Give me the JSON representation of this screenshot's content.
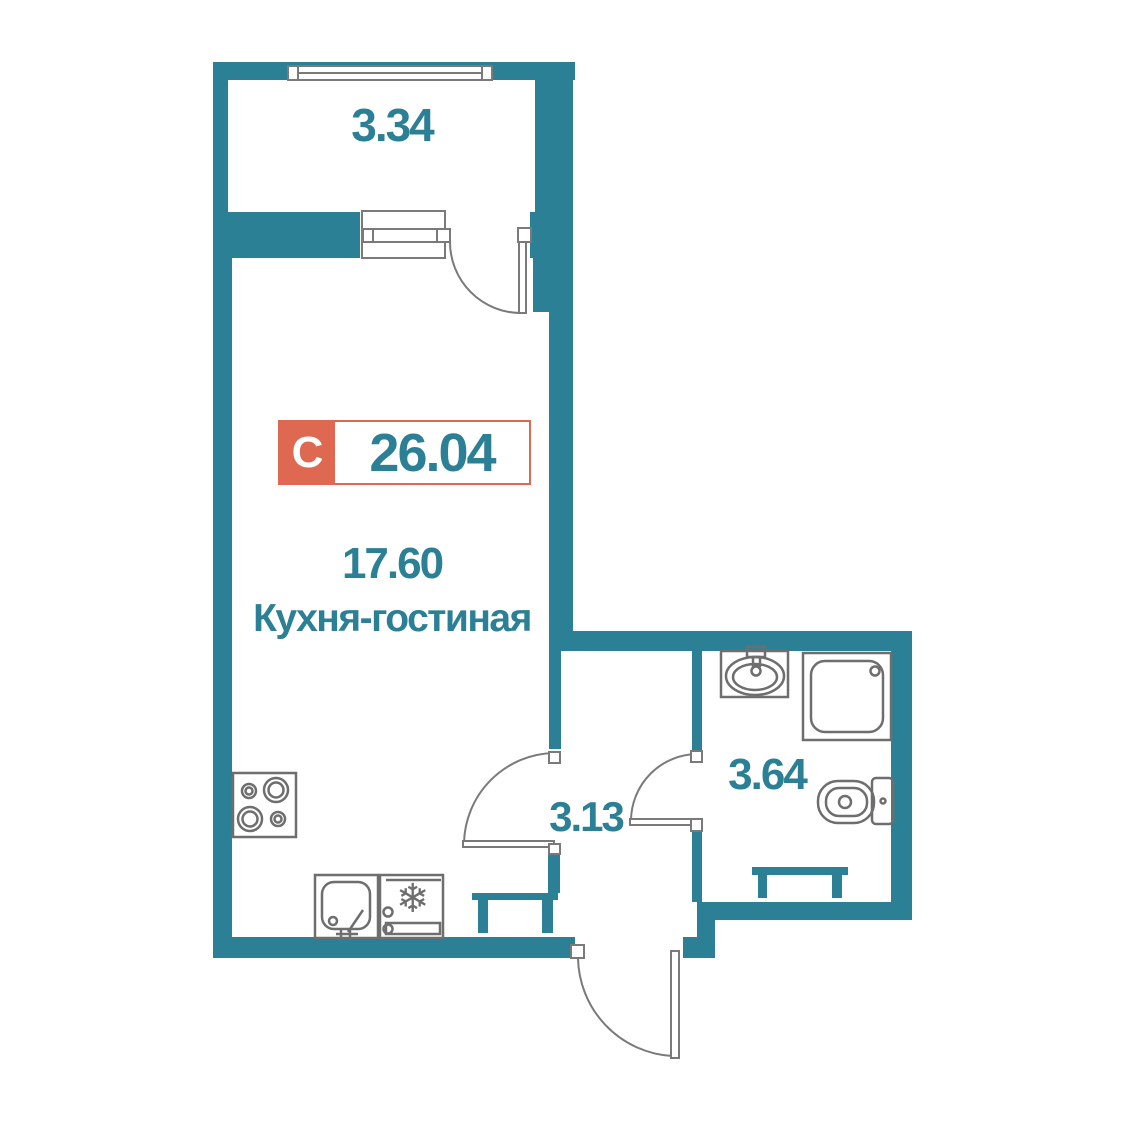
{
  "plan": {
    "badge": {
      "type_letter": "С",
      "total_area": "26.04"
    },
    "balcony": {
      "area": "3.34"
    },
    "kitchen_living": {
      "area": "17.60",
      "name": "Кухня-гостиная"
    },
    "hallway": {
      "area": "3.13"
    },
    "bathroom": {
      "area": "3.64"
    },
    "icons": {
      "snowflake": "❄"
    },
    "colors": {
      "wall_teal": "#2B8096",
      "badge_orange": "#DE6950",
      "fixture_gray": "#6E6E6E",
      "door_gray": "#7A7A7A",
      "background": "#FFFFFF"
    }
  }
}
